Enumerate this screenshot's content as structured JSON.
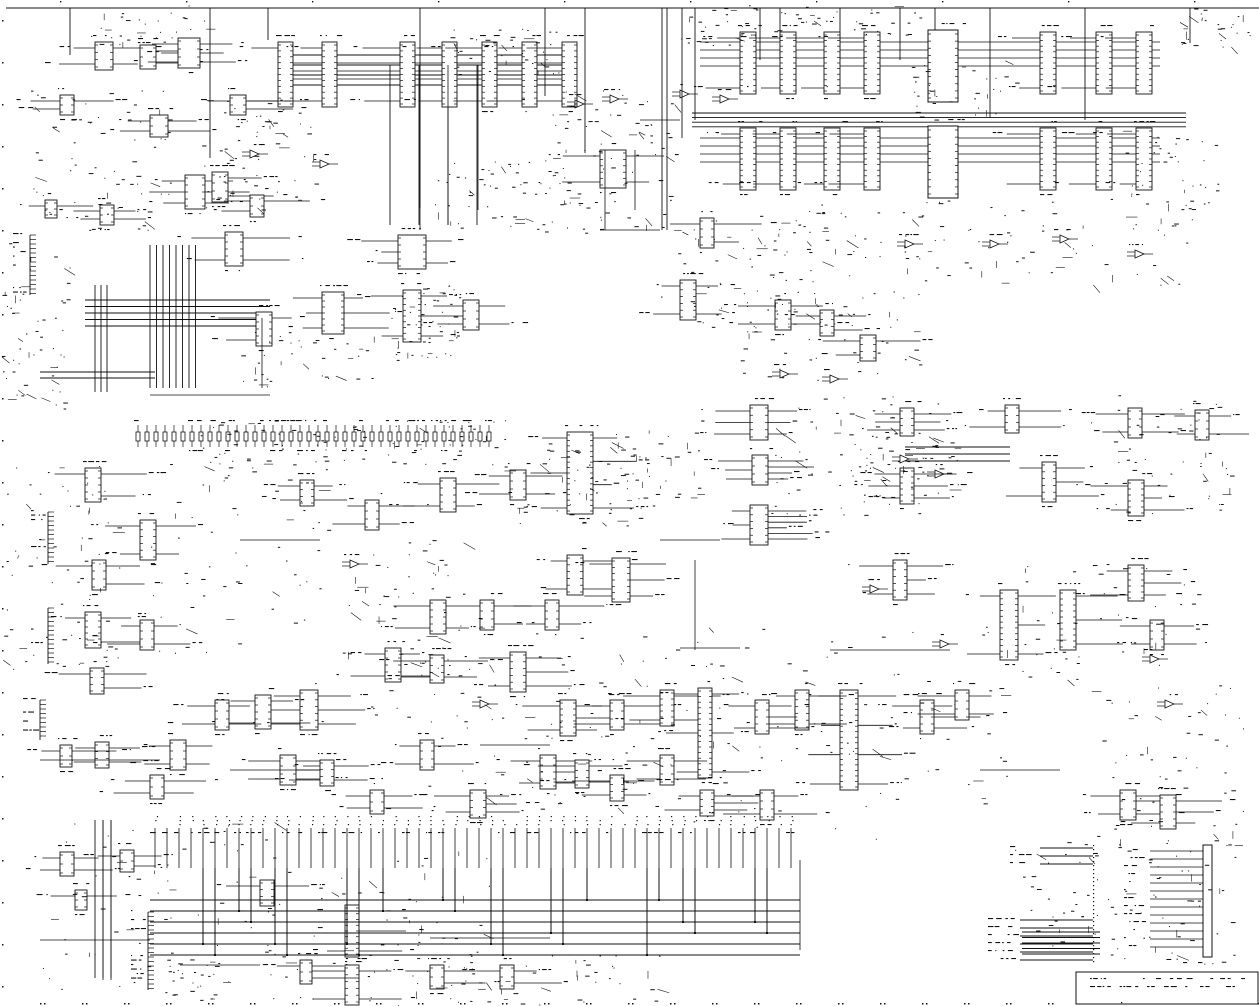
{
  "meta": {
    "kind": "scanned-circuit-schematic",
    "bg": "#ffffff",
    "ink": "#111111",
    "width": 1259,
    "height": 1006,
    "text_legible": false
  },
  "schematic": {
    "top_rule": {
      "y": 8,
      "x1": 6,
      "x2": 1259
    },
    "top_drops": [
      {
        "x": 70,
        "len": 47
      },
      {
        "x": 210,
        "len": 150
      },
      {
        "x": 268,
        "len": 32
      },
      {
        "x": 420,
        "len": 200
      },
      {
        "x": 545,
        "len": 88
      },
      {
        "x": 585,
        "len": 145
      },
      {
        "x": 662,
        "len": 222
      },
      {
        "x": 667,
        "len": 222
      },
      {
        "x": 682,
        "len": 130
      },
      {
        "x": 695,
        "len": 112
      },
      {
        "x": 760,
        "len": 52
      },
      {
        "x": 780,
        "len": 52
      },
      {
        "x": 840,
        "len": 52
      },
      {
        "x": 900,
        "len": 52
      },
      {
        "x": 935,
        "len": 40
      },
      {
        "x": 990,
        "len": 110
      },
      {
        "x": 1085,
        "len": 112
      },
      {
        "x": 1190,
        "len": 35
      }
    ],
    "buses": [
      {
        "dir": "h",
        "x": 692,
        "y": 113,
        "len": 494,
        "n": 4,
        "gap": 4.6
      },
      {
        "dir": "h",
        "x": 290,
        "y": 55,
        "len": 285,
        "n": 4,
        "gap": 10
      },
      {
        "dir": "h",
        "x": 85,
        "y": 300,
        "len": 185,
        "n": 5,
        "gap": 6.5
      },
      {
        "dir": "h",
        "x": 40,
        "y": 372,
        "len": 115,
        "n": 2,
        "gap": 6
      },
      {
        "dir": "v",
        "x": 150,
        "y": 245,
        "len": 143,
        "n": 8,
        "gap": 6.5
      },
      {
        "dir": "v",
        "x": 95,
        "y": 285,
        "len": 107,
        "n": 3,
        "gap": 6
      },
      {
        "dir": "v",
        "x": 390,
        "y": 65,
        "len": 160,
        "n": 4,
        "gap": 29
      },
      {
        "dir": "h",
        "x": 905,
        "y": 447,
        "len": 105,
        "n": 3,
        "gap": 7
      },
      {
        "dir": "h",
        "x": 1022,
        "y": 932,
        "len": 78,
        "n": 5,
        "gap": 5.5
      },
      {
        "dir": "v",
        "x": 95,
        "y": 820,
        "len": 158,
        "n": 3,
        "gap": 8
      }
    ],
    "dip_rows": [
      {
        "y": 32,
        "w": 16,
        "h": 62,
        "xs": [
          740,
          780,
          824,
          864,
          1040,
          1096,
          1136
        ],
        "bus_y_off": 10,
        "bus_n": 4,
        "bus_x1": 700,
        "bus_x2": 1160
      },
      {
        "y": 128,
        "w": 16,
        "h": 62,
        "xs": [
          740,
          780,
          824,
          864,
          1040,
          1096,
          1136
        ],
        "bus_y_off": 10,
        "bus_n": 4,
        "bus_x1": 700,
        "bus_x2": 1160
      },
      {
        "y": 42,
        "w": 15,
        "h": 65,
        "xs": [
          278,
          322,
          400,
          442,
          482,
          522,
          562
        ],
        "bus_y_off": 13,
        "bus_n": 4,
        "bus_x1": 290,
        "bus_x2": 570
      }
    ],
    "big_blocks": [
      {
        "x": 928,
        "y": 30,
        "w": 30,
        "h": 72
      },
      {
        "x": 928,
        "y": 126,
        "w": 30,
        "h": 72
      }
    ],
    "ics": [
      [
        95,
        42,
        18,
        28,
        2,
        2
      ],
      [
        140,
        45,
        16,
        24,
        0,
        2
      ],
      [
        178,
        38,
        22,
        30,
        3,
        3
      ],
      [
        60,
        95,
        14,
        20,
        2,
        1
      ],
      [
        150,
        115,
        18,
        22,
        2,
        2
      ],
      [
        230,
        95,
        16,
        20,
        1,
        2
      ],
      [
        185,
        175,
        20,
        34,
        3,
        3
      ],
      [
        212,
        172,
        16,
        30,
        0,
        2
      ],
      [
        250,
        195,
        14,
        22,
        2,
        1
      ],
      [
        45,
        200,
        12,
        18,
        1,
        1
      ],
      [
        100,
        205,
        14,
        20,
        2,
        2
      ],
      [
        225,
        232,
        18,
        34,
        2,
        2
      ],
      [
        398,
        235,
        28,
        34,
        3,
        2
      ],
      [
        322,
        292,
        22,
        42,
        3,
        3
      ],
      [
        256,
        312,
        16,
        34,
        2,
        1
      ],
      [
        403,
        290,
        18,
        52,
        2,
        3
      ],
      [
        463,
        300,
        16,
        30,
        2,
        2
      ],
      [
        600,
        150,
        26,
        38,
        2,
        2
      ],
      [
        680,
        280,
        16,
        40,
        2,
        2
      ],
      [
        700,
        218,
        14,
        30,
        1,
        2
      ],
      [
        775,
        300,
        16,
        30,
        2,
        2
      ],
      [
        820,
        310,
        14,
        26,
        1,
        2
      ],
      [
        860,
        335,
        16,
        26,
        2,
        1
      ],
      [
        750,
        405,
        18,
        35,
        3,
        3
      ],
      [
        752,
        455,
        16,
        30,
        3,
        4
      ],
      [
        750,
        505,
        18,
        40,
        3,
        6
      ],
      [
        900,
        408,
        14,
        28,
        3,
        3
      ],
      [
        1005,
        405,
        14,
        28,
        2,
        2
      ],
      [
        900,
        468,
        14,
        36,
        3,
        3
      ],
      [
        1042,
        462,
        14,
        40,
        2,
        3
      ],
      [
        1128,
        480,
        16,
        36,
        2,
        3
      ],
      [
        1128,
        565,
        16,
        36,
        2,
        3
      ],
      [
        1195,
        410,
        14,
        30,
        2,
        2
      ],
      [
        1128,
        408,
        14,
        30,
        2,
        2
      ],
      [
        893,
        560,
        14,
        40,
        2,
        3
      ],
      [
        1000,
        590,
        18,
        70,
        2,
        3
      ],
      [
        1060,
        590,
        16,
        60,
        0,
        3
      ],
      [
        1150,
        620,
        14,
        30,
        2,
        2
      ],
      [
        567,
        432,
        26,
        82,
        3,
        4
      ],
      [
        510,
        470,
        16,
        30,
        2,
        2
      ],
      [
        440,
        478,
        16,
        34,
        2,
        2
      ],
      [
        365,
        500,
        14,
        30,
        2,
        2
      ],
      [
        300,
        480,
        14,
        26,
        2,
        2
      ],
      [
        567,
        555,
        16,
        40,
        2,
        2
      ],
      [
        612,
        558,
        18,
        44,
        2,
        3
      ],
      [
        545,
        600,
        14,
        30,
        2,
        2
      ],
      [
        430,
        600,
        16,
        34,
        2,
        2
      ],
      [
        480,
        600,
        14,
        30,
        0,
        2
      ],
      [
        385,
        648,
        16,
        34,
        2,
        2
      ],
      [
        430,
        655,
        14,
        28,
        2,
        2
      ],
      [
        510,
        652,
        16,
        40,
        2,
        3
      ],
      [
        560,
        700,
        16,
        36,
        2,
        3
      ],
      [
        610,
        700,
        14,
        30,
        2,
        2
      ],
      [
        660,
        690,
        14,
        36,
        2,
        2
      ],
      [
        698,
        688,
        14,
        90,
        3,
        3
      ],
      [
        840,
        690,
        18,
        100,
        4,
        4
      ],
      [
        795,
        690,
        14,
        40,
        2,
        2
      ],
      [
        755,
        700,
        14,
        34,
        2,
        3
      ],
      [
        920,
        700,
        14,
        34,
        2,
        3
      ],
      [
        955,
        690,
        14,
        30,
        2,
        2
      ],
      [
        660,
        755,
        14,
        30,
        2,
        2
      ],
      [
        540,
        755,
        16,
        34,
        2,
        3
      ],
      [
        575,
        760,
        14,
        28,
        2,
        2
      ],
      [
        420,
        740,
        14,
        30,
        2,
        2
      ],
      [
        300,
        690,
        18,
        40,
        3,
        3
      ],
      [
        255,
        695,
        16,
        34,
        2,
        2
      ],
      [
        215,
        700,
        14,
        30,
        2,
        2
      ],
      [
        280,
        755,
        16,
        30,
        2,
        3
      ],
      [
        320,
        760,
        14,
        26,
        2,
        2
      ],
      [
        370,
        790,
        14,
        24,
        2,
        2
      ],
      [
        470,
        790,
        16,
        28,
        2,
        3
      ],
      [
        610,
        775,
        14,
        26,
        2,
        2
      ],
      [
        700,
        790,
        14,
        26,
        2,
        3
      ],
      [
        760,
        790,
        14,
        30,
        2,
        2
      ],
      [
        1120,
        790,
        16,
        30,
        2,
        2
      ],
      [
        1160,
        795,
        16,
        34,
        2,
        3
      ],
      [
        85,
        468,
        16,
        34,
        1,
        2
      ],
      [
        140,
        520,
        16,
        40,
        2,
        2
      ],
      [
        92,
        560,
        14,
        30,
        1,
        2
      ],
      [
        85,
        612,
        16,
        36,
        1,
        2
      ],
      [
        140,
        620,
        14,
        30,
        2,
        2
      ],
      [
        90,
        668,
        14,
        26,
        1,
        2
      ],
      [
        170,
        740,
        16,
        30,
        2,
        2
      ],
      [
        95,
        742,
        14,
        26,
        2,
        2
      ],
      [
        60,
        745,
        12,
        22,
        1,
        1
      ],
      [
        150,
        775,
        14,
        24,
        2,
        2
      ],
      [
        345,
        905,
        14,
        52,
        2,
        3
      ],
      [
        260,
        880,
        14,
        26,
        2,
        2
      ],
      [
        60,
        852,
        14,
        24,
        2,
        2
      ],
      [
        120,
        850,
        14,
        22,
        1,
        2
      ],
      [
        75,
        890,
        12,
        20,
        1,
        1
      ],
      [
        345,
        965,
        14,
        40,
        2,
        2
      ],
      [
        300,
        960,
        12,
        24,
        1,
        2
      ],
      [
        430,
        965,
        14,
        24,
        1,
        2
      ],
      [
        500,
        965,
        14,
        24,
        1,
        2
      ]
    ],
    "gates": [
      [
        905,
        240
      ],
      [
        990,
        240
      ],
      [
        1060,
        235
      ],
      [
        1135,
        250
      ],
      [
        780,
        370
      ],
      [
        830,
        375
      ],
      [
        900,
        455
      ],
      [
        935,
        470
      ],
      [
        1150,
        655
      ],
      [
        1165,
        700
      ],
      [
        680,
        90
      ],
      [
        720,
        95
      ],
      [
        250,
        150
      ],
      [
        320,
        160
      ],
      [
        870,
        585
      ],
      [
        940,
        640
      ],
      [
        480,
        700
      ],
      [
        350,
        560
      ],
      [
        610,
        95
      ],
      [
        575,
        100
      ]
    ],
    "conns": [
      {
        "x": 48,
        "y": 512,
        "h": 52
      },
      {
        "x": 48,
        "y": 608,
        "h": 56
      },
      {
        "x": 40,
        "y": 700,
        "h": 40
      },
      {
        "x": 148,
        "y": 912,
        "h": 78
      },
      {
        "x": 30,
        "y": 235,
        "h": 60
      }
    ],
    "resistor_row": {
      "x": 138,
      "y": 432,
      "count": 40,
      "pitch": 9
    },
    "pin_row": {
      "x": 155,
      "y": 828,
      "count": 54,
      "pitch": 12,
      "stub": 40,
      "drops": [
        4,
        5,
        7,
        8,
        10,
        11,
        16,
        17,
        19,
        24,
        25,
        28,
        29,
        33,
        34,
        36,
        41,
        42,
        44,
        45,
        50,
        51
      ]
    },
    "bottom_bus": {
      "x1": 150,
      "x2": 800,
      "y": 900,
      "n": 6,
      "gap": 11
    },
    "conn_stubs": {
      "x1": 1040,
      "x2": 1093,
      "top_ys": [
        848,
        856,
        864
      ],
      "bot_ys": [
        920,
        928,
        936,
        944,
        952,
        960
      ],
      "dash_x": 1093,
      "dash_y1": 845,
      "dash_y2": 962
    },
    "edge_conn": {
      "x": 1203,
      "y": 845,
      "w": 9,
      "h": 112,
      "stub_x": 1150,
      "stub_step": 8,
      "stubs": 13
    },
    "title_block": {
      "x": 1076,
      "y": 972,
      "w": 182,
      "h": 32,
      "divider_y": 988,
      "text_rows": 2
    },
    "hlines": [
      [
        600,
        230,
        60
      ],
      [
        640,
        120,
        40
      ],
      [
        150,
        395,
        120
      ],
      [
        40,
        760,
        120
      ],
      [
        230,
        770,
        90
      ],
      [
        830,
        650,
        120
      ],
      [
        680,
        648,
        60
      ],
      [
        980,
        770,
        80
      ],
      [
        480,
        745,
        70
      ],
      [
        660,
        540,
        60
      ],
      [
        240,
        540,
        80
      ],
      [
        40,
        940,
        110
      ],
      [
        180,
        965,
        80
      ],
      [
        430,
        938,
        120
      ],
      [
        980,
        120,
        0
      ]
    ],
    "vlines": [
      [
        420,
        65,
        165
      ],
      [
        448,
        65,
        160
      ],
      [
        478,
        65,
        145
      ],
      [
        605,
        150,
        80
      ],
      [
        635,
        150,
        60
      ],
      [
        262,
        318,
        70
      ],
      [
        695,
        560,
        90
      ],
      [
        800,
        860,
        90
      ],
      [
        103,
        820,
        160
      ],
      [
        111,
        820,
        160
      ]
    ],
    "noise_regions": [
      [
        390,
        285,
        70,
        75,
        60
      ],
      [
        545,
        90,
        130,
        150,
        90
      ],
      [
        430,
        160,
        140,
        70,
        60
      ],
      [
        200,
        90,
        120,
        120,
        70
      ],
      [
        30,
        90,
        140,
        140,
        80
      ],
      [
        0,
        240,
        70,
        170,
        60
      ],
      [
        240,
        330,
        140,
        60,
        40
      ],
      [
        200,
        420,
        310,
        45,
        90
      ],
      [
        500,
        430,
        140,
        100,
        60
      ],
      [
        620,
        430,
        80,
        80,
        40
      ],
      [
        770,
        395,
        170,
        120,
        80
      ],
      [
        860,
        430,
        100,
        60,
        40
      ],
      [
        1090,
        395,
        140,
        120,
        60
      ],
      [
        905,
        200,
        290,
        85,
        70
      ],
      [
        660,
        215,
        190,
        120,
        70
      ],
      [
        740,
        290,
        180,
        90,
        50
      ],
      [
        0,
        460,
        120,
        220,
        80
      ],
      [
        150,
        460,
        180,
        200,
        70
      ],
      [
        330,
        540,
        150,
        130,
        60
      ],
      [
        360,
        630,
        300,
        180,
        90
      ],
      [
        660,
        620,
        350,
        220,
        90
      ],
      [
        1020,
        560,
        180,
        120,
        50
      ],
      [
        1090,
        680,
        160,
        160,
        60
      ],
      [
        40,
        820,
        280,
        180,
        80
      ],
      [
        330,
        850,
        160,
        160,
        60
      ],
      [
        400,
        955,
        260,
        50,
        50
      ],
      [
        1010,
        840,
        120,
        120,
        50
      ],
      [
        1140,
        840,
        100,
        130,
        50
      ],
      [
        680,
        5,
        80,
        40,
        30
      ],
      [
        1180,
        5,
        70,
        45,
        30
      ],
      [
        90,
        5,
        120,
        40,
        30
      ],
      [
        440,
        25,
        120,
        50,
        40
      ],
      [
        740,
        200,
        200,
        60,
        40
      ],
      [
        910,
        60,
        120,
        60,
        40
      ],
      [
        1100,
        130,
        120,
        80,
        40
      ],
      [
        740,
        5,
        180,
        30,
        40
      ],
      [
        165,
        955,
        60,
        45,
        30
      ]
    ],
    "frame": {
      "left_dash_x": 2,
      "bottom_dash_y": 1003,
      "step": 42
    }
  }
}
